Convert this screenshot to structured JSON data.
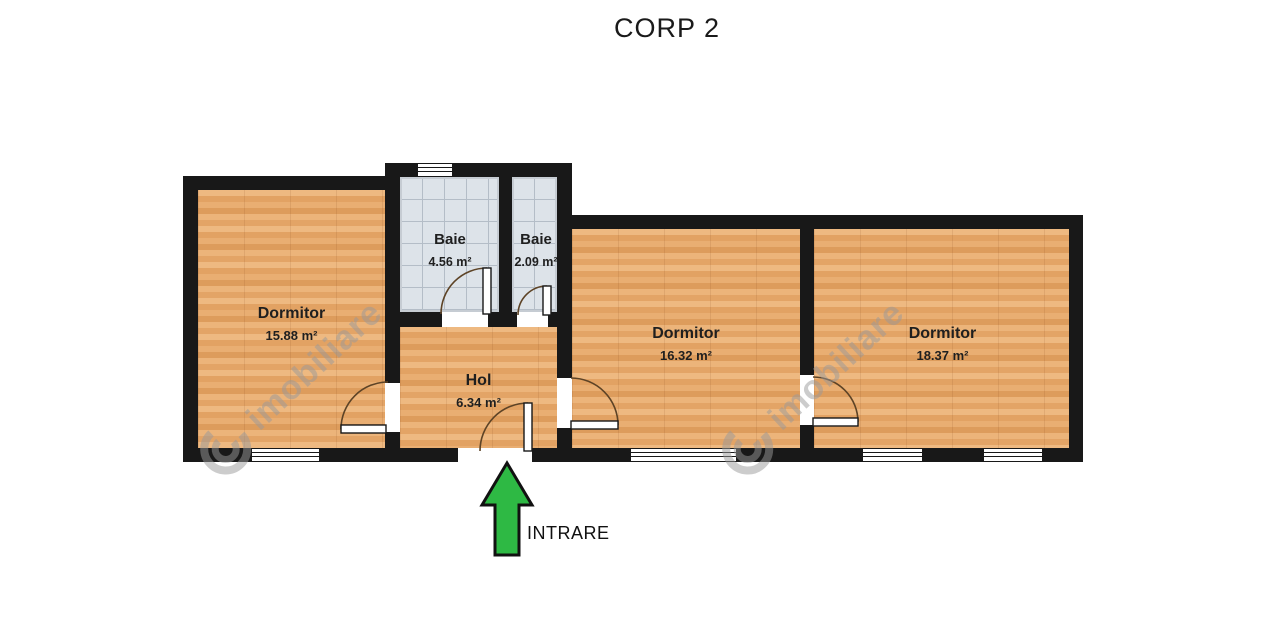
{
  "title": "CORP 2",
  "entrance": {
    "label": "INTRARE"
  },
  "watermark": {
    "text": "imobiliare"
  },
  "rooms": {
    "dormitor1": {
      "name": "Dormitor",
      "area": "15.88 m²"
    },
    "baie1": {
      "name": "Baie",
      "area": "4.56 m²"
    },
    "baie2": {
      "name": "Baie",
      "area": "2.09 m²"
    },
    "hol": {
      "name": "Hol",
      "area": "6.34 m²"
    },
    "dormitor2": {
      "name": "Dormitor",
      "area": "16.32 m²"
    },
    "dormitor3": {
      "name": "Dormitor",
      "area": "18.37 m²"
    }
  },
  "colors": {
    "wall": "#181818",
    "wood_floor": "#e6a96e",
    "tile_floor": "#dde3e9",
    "arrow_green": "#2eb944",
    "watermark_gray": "#9a9a9a"
  }
}
